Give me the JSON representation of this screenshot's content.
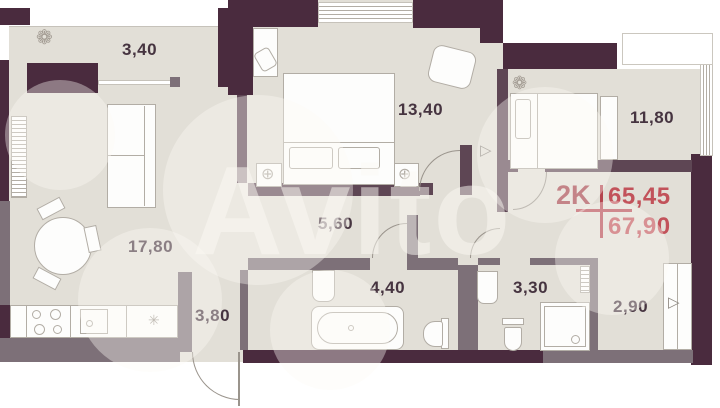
{
  "plan": {
    "type_label": "2K",
    "area_living": "65,45",
    "area_total": "67,90",
    "rooms": [
      {
        "id": "balcony",
        "area": "3,40"
      },
      {
        "id": "bedroom-1",
        "area": "13,40"
      },
      {
        "id": "bedroom-2",
        "area": "11,80"
      },
      {
        "id": "living-kitchen",
        "area": "17,80"
      },
      {
        "id": "corridor",
        "area": "5,60"
      },
      {
        "id": "hallway",
        "area": "3,80"
      },
      {
        "id": "bathroom",
        "area": "4,40"
      },
      {
        "id": "wc",
        "area": "3,30"
      },
      {
        "id": "entry",
        "area": "2,90"
      }
    ],
    "icons": {
      "plant": "❁",
      "snowflake": "✳",
      "lamp": "⊕",
      "door_leaf": "▷"
    },
    "colors": {
      "wall_exterior": "#4a2b3e",
      "wall_interior_mid": "#5e4654",
      "wall_interior_light": "#7d7078",
      "floor": "#e2dfd7",
      "accent_type": "#a23c46",
      "accent_numbers": "#c2525a",
      "room_label": "#463440"
    },
    "watermark": {
      "text": "Avito"
    }
  }
}
